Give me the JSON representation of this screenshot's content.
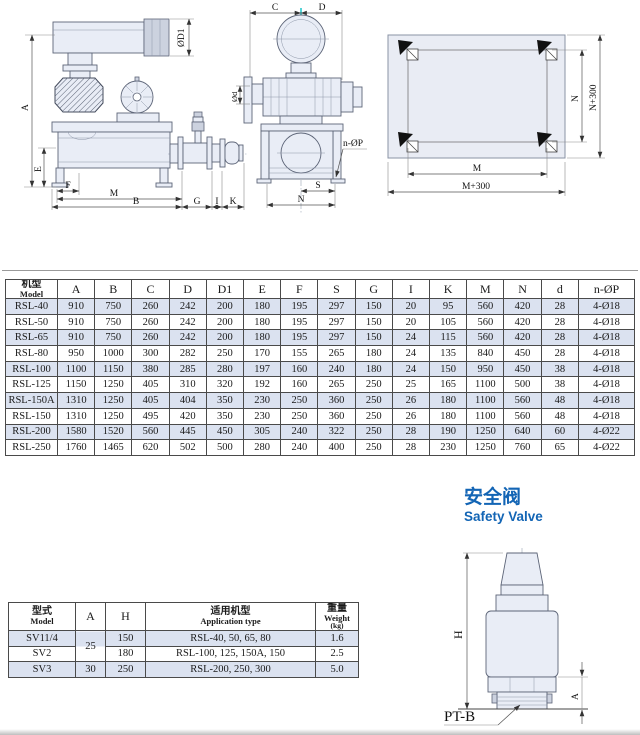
{
  "safety_valve_title": {
    "zh": "安全阀",
    "en": "Safety Valve"
  },
  "dims": {
    "side": {
      "A": "A",
      "E": "E",
      "F": "F",
      "M": "M",
      "B": "B",
      "G": "G",
      "I": "I",
      "K": "K",
      "D1": "ØD1"
    },
    "front": {
      "C": "C",
      "D": "D",
      "d": "Ød",
      "nP": "n-ØP",
      "S": "S",
      "N": "N"
    },
    "plan": {
      "M": "M",
      "M300": "M+300",
      "N": "N",
      "N300": "N+300"
    },
    "valve": {
      "H": "H",
      "A": "A",
      "PTB": "PT-B"
    }
  },
  "main_table": {
    "headers": [
      {
        "zh": "机型",
        "en": "Model"
      },
      "A",
      "B",
      "C",
      "D",
      "D1",
      "E",
      "F",
      "S",
      "G",
      "I",
      "K",
      "M",
      "N",
      "d",
      "n-ØP"
    ],
    "rows": [
      [
        "RSL-40",
        "910",
        "750",
        "260",
        "242",
        "200",
        "180",
        "195",
        "297",
        "150",
        "20",
        "95",
        "560",
        "420",
        "28",
        "4-Ø18"
      ],
      [
        "RSL-50",
        "910",
        "750",
        "260",
        "242",
        "200",
        "180",
        "195",
        "297",
        "150",
        "20",
        "105",
        "560",
        "420",
        "28",
        "4-Ø18"
      ],
      [
        "RSL-65",
        "910",
        "750",
        "260",
        "242",
        "200",
        "180",
        "195",
        "297",
        "150",
        "24",
        "115",
        "560",
        "420",
        "28",
        "4-Ø18"
      ],
      [
        "RSL-80",
        "950",
        "1000",
        "300",
        "282",
        "250",
        "170",
        "155",
        "265",
        "180",
        "24",
        "135",
        "840",
        "450",
        "28",
        "4-Ø18"
      ],
      [
        "RSL-100",
        "1100",
        "1150",
        "380",
        "285",
        "280",
        "197",
        "160",
        "240",
        "180",
        "24",
        "150",
        "950",
        "450",
        "38",
        "4-Ø18"
      ],
      [
        "RSL-125",
        "1150",
        "1250",
        "405",
        "310",
        "320",
        "192",
        "160",
        "265",
        "250",
        "25",
        "165",
        "1100",
        "500",
        "38",
        "4-Ø18"
      ],
      [
        "RSL-150A",
        "1310",
        "1250",
        "405",
        "404",
        "350",
        "230",
        "250",
        "360",
        "250",
        "26",
        "180",
        "1100",
        "560",
        "48",
        "4-Ø18"
      ],
      [
        "RSL-150",
        "1310",
        "1250",
        "495",
        "420",
        "350",
        "230",
        "250",
        "360",
        "250",
        "26",
        "180",
        "1100",
        "560",
        "48",
        "4-Ø18"
      ],
      [
        "RSL-200",
        "1580",
        "1520",
        "560",
        "445",
        "450",
        "305",
        "240",
        "322",
        "250",
        "28",
        "190",
        "1250",
        "640",
        "60",
        "4-Ø22"
      ],
      [
        "RSL-250",
        "1760",
        "1465",
        "620",
        "502",
        "500",
        "280",
        "240",
        "400",
        "250",
        "28",
        "230",
        "1250",
        "760",
        "65",
        "4-Ø22"
      ]
    ]
  },
  "valve_table": {
    "header": {
      "model_zh": "型式",
      "model_en": "Model",
      "a": "A",
      "h": "H",
      "app_zh": "适用机型",
      "app_en": "Application type",
      "weight_zh": "重量",
      "weight_en": "Weight",
      "weight_unit": "(kg)"
    },
    "rows": [
      {
        "model": "SV11/4",
        "a": "25",
        "a_rowspan": 2,
        "h": "150",
        "app": "RSL-40, 50, 65, 80",
        "weight": "1.6"
      },
      {
        "model": "SV2",
        "a": null,
        "h": "180",
        "app": "RSL-100, 125, 150A, 150",
        "weight": "2.5"
      },
      {
        "model": "SV3",
        "a": "30",
        "h": "250",
        "app": "RSL-200, 250, 300",
        "weight": "5.0"
      }
    ]
  }
}
